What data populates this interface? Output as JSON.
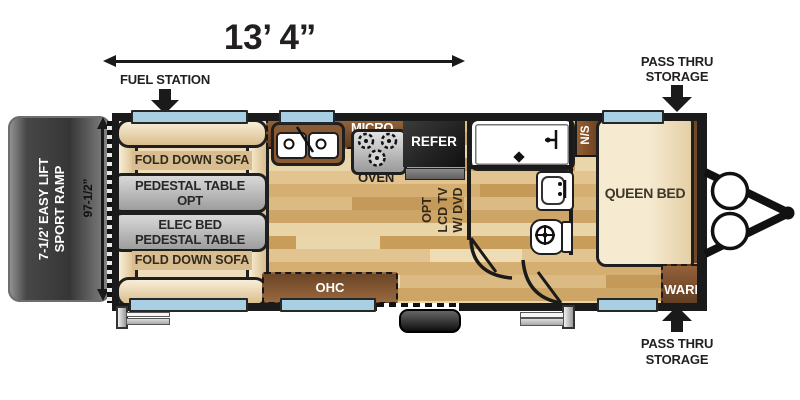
{
  "dimensions": {
    "width_label": "13’ 4”",
    "height_label": "97-1/2”"
  },
  "callouts": {
    "fuel_station": "FUEL STATION",
    "pass_thru_top_line1": "PASS THRU",
    "pass_thru_top_line2": "STORAGE",
    "pass_thru_bottom_line1": "PASS THRU",
    "pass_thru_bottom_line2": "STORAGE"
  },
  "ramp": {
    "line1": "7-1/2’ EASY LIFT",
    "line2": "SPORT RAMP"
  },
  "lounge": {
    "sofa_top": "FOLD DOWN SOFA",
    "table_opt_line1": "PEDESTAL TABLE",
    "table_opt_line2": "OPT",
    "table_bed_line1": "ELEC BED",
    "table_bed_line2": "PEDESTAL TABLE",
    "sofa_bottom": "FOLD DOWN SOFA"
  },
  "kitchen": {
    "ohc": "OHC",
    "micro": "MICRO",
    "oven": "OVEN",
    "refer": "REFER"
  },
  "tv": {
    "line1": "OPT",
    "line2": "LCD TV",
    "line3": "W/ DVD"
  },
  "bedroom": {
    "nightstand": "N/S",
    "bed": "QUEEN BED",
    "wardrobe": "WARD"
  },
  "bottom_cabinet": {
    "ohc": "OHC"
  },
  "colors": {
    "wall": "#1a1a1a",
    "window_blue": "#a9cfe2",
    "cabinet_brown": "#7a5230",
    "table_gray": "#bfbfbf",
    "sofa_beige": "#eedcba",
    "ramp_gray": "#3c3c3c",
    "fixture_white": "#ffffff"
  }
}
